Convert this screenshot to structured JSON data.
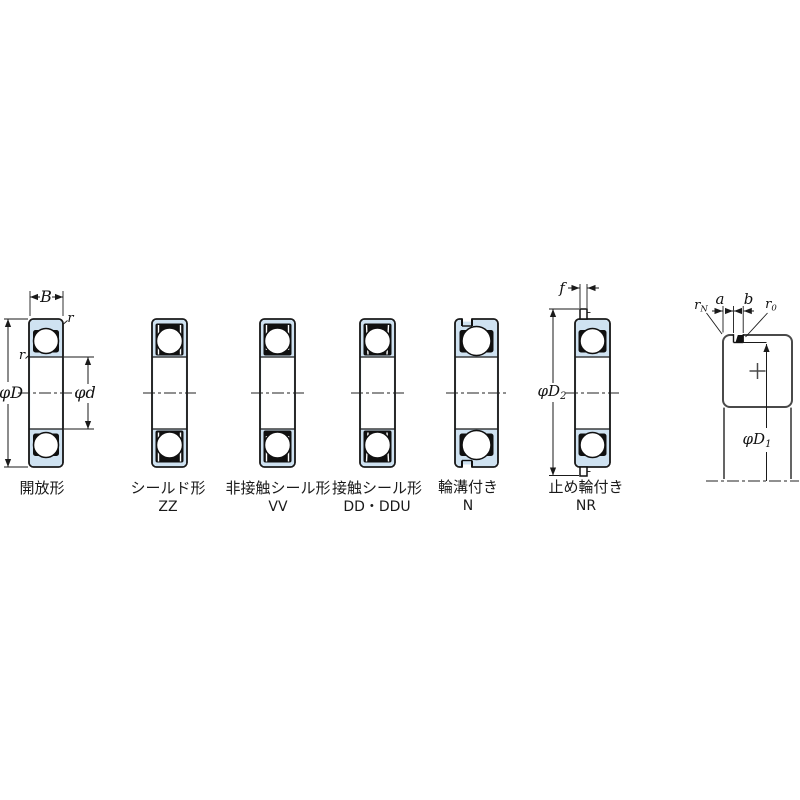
{
  "bearings": [
    {
      "label": "開放形",
      "code": ""
    },
    {
      "label": "シールド形",
      "code": "ZZ"
    },
    {
      "label": "非接触シール形",
      "code": "VV"
    },
    {
      "label": "接触シール形",
      "code": "DD・DDU"
    },
    {
      "label": "輪溝付き",
      "code": "N"
    },
    {
      "label": "止め輪付き",
      "code": "NR"
    }
  ],
  "dims": {
    "B": "B",
    "phiD": "φD",
    "phid": "φd",
    "r": "r",
    "f": "f",
    "a": "a",
    "b": "b",
    "phiD2": {
      "base": "φD",
      "sub": "2"
    },
    "phiD1": {
      "base": "φD",
      "sub": "1"
    },
    "rN": {
      "base": "r",
      "sub": "N"
    },
    "r0": {
      "base": "r",
      "sub": "0"
    }
  },
  "colors": {
    "ring_fill": "#cfe2f1",
    "line": "#1a1a1a",
    "detail_line": "#4a4a4a",
    "background": "#ffffff"
  }
}
